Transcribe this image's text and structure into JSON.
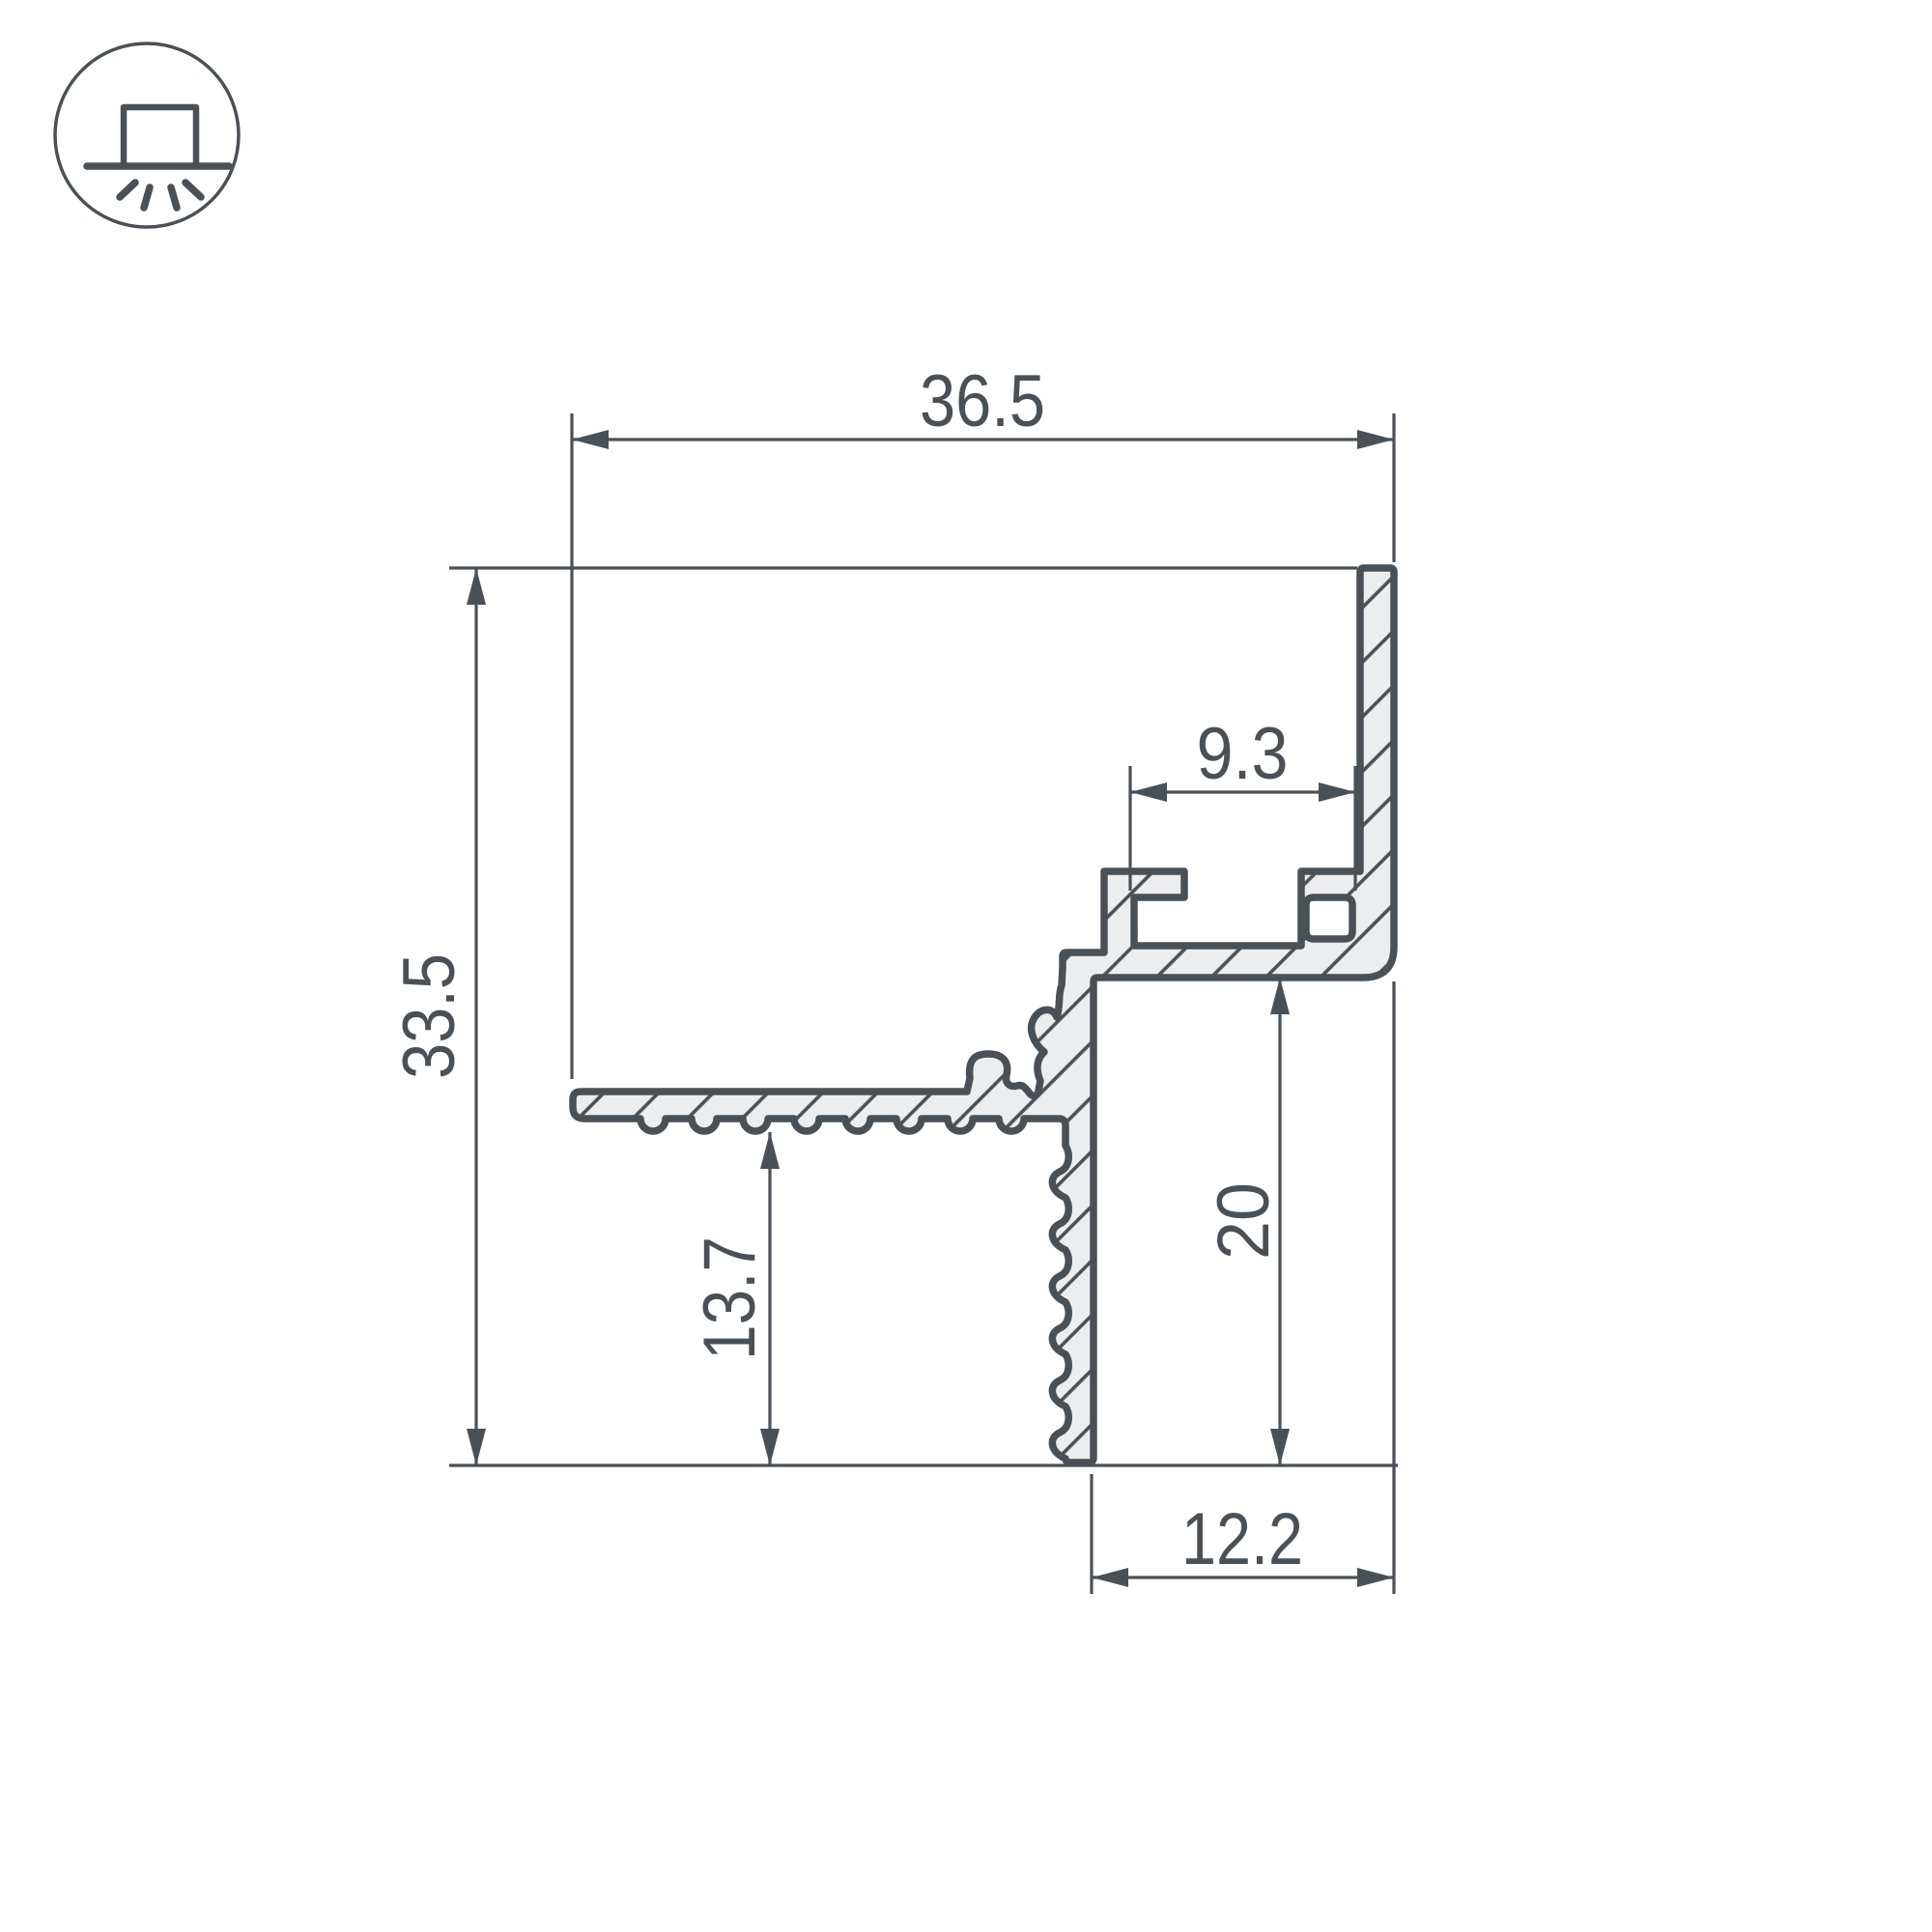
{
  "drawing": {
    "kind": "profile-cross-section",
    "colors": {
      "line": "#4a5156",
      "profile_fill": "#ebedee",
      "background": "#ffffff"
    },
    "icon": {
      "name": "surface-mounted-light",
      "description": "square luminaire on ceiling line with rays shining down, inside circle"
    },
    "dimensions": {
      "overall_width": {
        "label": "36.5"
      },
      "overall_height": {
        "label": "33.5"
      },
      "slot_width": {
        "label": "9.3"
      },
      "left_drop_height": {
        "label": "13.7"
      },
      "right_drop_height": {
        "label": "20"
      },
      "bottom_width": {
        "label": "12.2"
      }
    }
  }
}
